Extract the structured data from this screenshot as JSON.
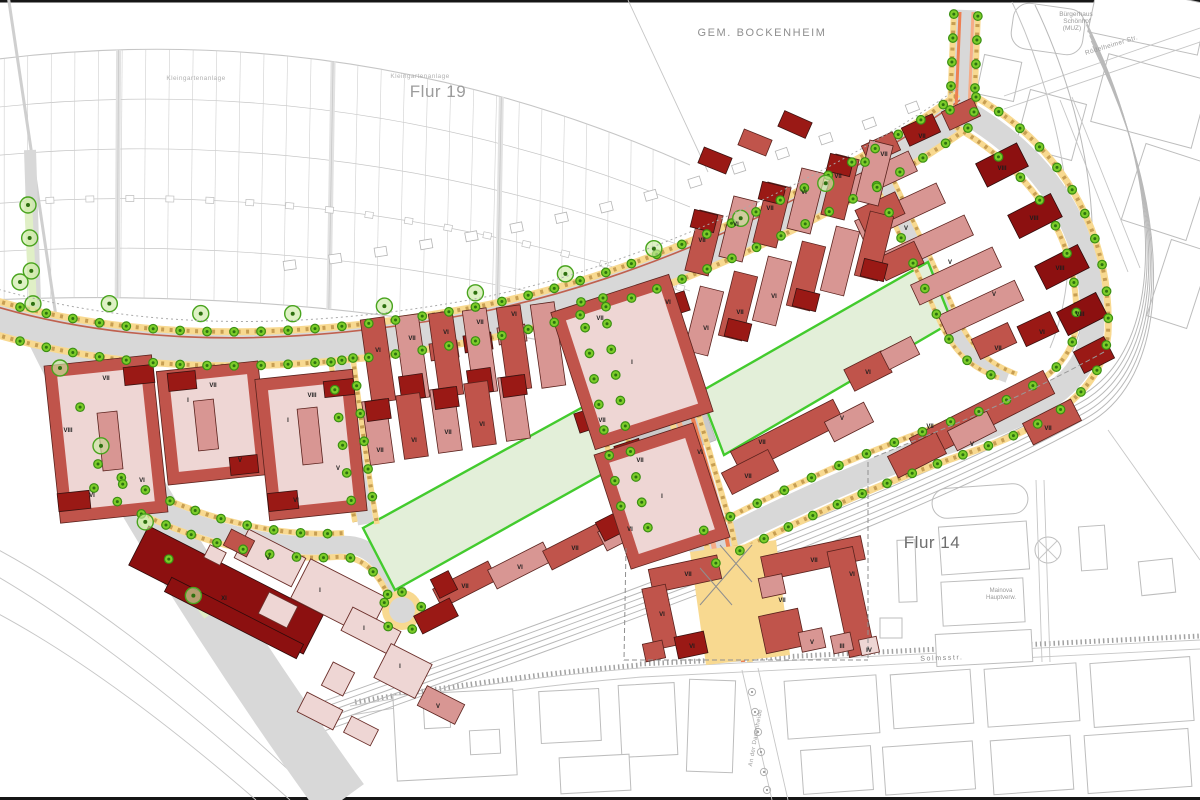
{
  "map": {
    "area_labels": [
      {
        "text": "GEM. BOCKENHEIM",
        "x": 762,
        "y": 36,
        "size": 11,
        "color": "#8f8f8f",
        "spacing": 1.6
      },
      {
        "text": "Flur 19",
        "x": 438,
        "y": 97,
        "size": 17,
        "color": "#9c9c9c",
        "spacing": 0.5
      },
      {
        "text": "Flur 14",
        "x": 932,
        "y": 548,
        "size": 17,
        "color": "#6e6e6e",
        "spacing": 0.5
      },
      {
        "text": "Kleingartenanlage",
        "x": 196,
        "y": 80,
        "size": 6.5,
        "color": "#b2b2b2",
        "spacing": 0.4
      },
      {
        "text": "Kleingartenanlage",
        "x": 420,
        "y": 78,
        "size": 6.5,
        "color": "#b2b2b2",
        "spacing": 0.4
      },
      {
        "text": "Bürgerhaus",
        "x": 1076,
        "y": 16,
        "size": 6.5,
        "color": "#9a9a9a",
        "spacing": 0
      },
      {
        "text": "Schönhof",
        "x": 1077,
        "y": 23,
        "size": 6.5,
        "color": "#9a9a9a",
        "spacing": 0
      },
      {
        "text": "(MUZ)",
        "x": 1072,
        "y": 30,
        "size": 6.5,
        "color": "#9a9a9a",
        "spacing": 0
      },
      {
        "text": "Mainova",
        "x": 1001,
        "y": 592,
        "size": 6,
        "color": "#9a9a9a",
        "spacing": 0
      },
      {
        "text": "Hauptverw.",
        "x": 1001,
        "y": 599,
        "size": 6,
        "color": "#9a9a9a",
        "spacing": 0
      }
    ],
    "street_labels": [
      {
        "text": "Rödelheimer Str.",
        "x": 1112,
        "y": 47,
        "size": 6.5,
        "color": "#9a9a9a",
        "rotate": -17,
        "spacing": 0.4
      },
      {
        "text": "Solmsstr.",
        "x": 942,
        "y": 660,
        "size": 7,
        "color": "#8a8a8a",
        "rotate": -2,
        "spacing": 1.6
      },
      {
        "text": "An der Dammheide",
        "x": 757,
        "y": 738,
        "size": 6,
        "color": "#9a9a9a",
        "rotate": -80,
        "spacing": 0.4
      }
    ],
    "building_floor_labels": [
      {
        "t": "VII",
        "x": 106,
        "y": 380
      },
      {
        "t": "VIII",
        "x": 68,
        "y": 432
      },
      {
        "t": "VI",
        "x": 92,
        "y": 497
      },
      {
        "t": "VI",
        "x": 142,
        "y": 482
      },
      {
        "t": "VII",
        "x": 213,
        "y": 387
      },
      {
        "t": "I",
        "x": 188,
        "y": 402
      },
      {
        "t": "V",
        "x": 240,
        "y": 462
      },
      {
        "t": "VIII",
        "x": 312,
        "y": 397
      },
      {
        "t": "I",
        "x": 288,
        "y": 422
      },
      {
        "t": "V",
        "x": 338,
        "y": 470
      },
      {
        "t": "VI",
        "x": 296,
        "y": 502
      },
      {
        "t": "VI",
        "x": 378,
        "y": 352
      },
      {
        "t": "VII",
        "x": 412,
        "y": 340
      },
      {
        "t": "VI",
        "x": 446,
        "y": 334
      },
      {
        "t": "VII",
        "x": 480,
        "y": 324
      },
      {
        "t": "VI",
        "x": 514,
        "y": 316
      },
      {
        "t": "VII",
        "x": 380,
        "y": 452
      },
      {
        "t": "VI",
        "x": 414,
        "y": 442
      },
      {
        "t": "VII",
        "x": 448,
        "y": 434
      },
      {
        "t": "VI",
        "x": 482,
        "y": 426
      },
      {
        "t": "VII",
        "x": 600,
        "y": 320
      },
      {
        "t": "VI",
        "x": 668,
        "y": 304
      },
      {
        "t": "VII",
        "x": 602,
        "y": 422
      },
      {
        "t": "I",
        "x": 632,
        "y": 364
      },
      {
        "t": "VII",
        "x": 640,
        "y": 462
      },
      {
        "t": "VI",
        "x": 700,
        "y": 454
      },
      {
        "t": "I",
        "x": 662,
        "y": 498
      },
      {
        "t": "VII",
        "x": 702,
        "y": 242
      },
      {
        "t": "VI",
        "x": 736,
        "y": 226
      },
      {
        "t": "VII",
        "x": 770,
        "y": 210
      },
      {
        "t": "VI",
        "x": 804,
        "y": 194
      },
      {
        "t": "VII",
        "x": 838,
        "y": 178
      },
      {
        "t": "VI",
        "x": 706,
        "y": 330
      },
      {
        "t": "VII",
        "x": 740,
        "y": 314
      },
      {
        "t": "VI",
        "x": 774,
        "y": 298
      },
      {
        "t": "VII",
        "x": 884,
        "y": 156
      },
      {
        "t": "VII",
        "x": 922,
        "y": 138
      },
      {
        "t": "VIII",
        "x": 1002,
        "y": 170
      },
      {
        "t": "VIII",
        "x": 1034,
        "y": 220
      },
      {
        "t": "VIII",
        "x": 1060,
        "y": 270
      },
      {
        "t": "VIII",
        "x": 1080,
        "y": 316
      },
      {
        "t": "V",
        "x": 906,
        "y": 230
      },
      {
        "t": "V",
        "x": 950,
        "y": 264
      },
      {
        "t": "V",
        "x": 994,
        "y": 296
      },
      {
        "t": "VII",
        "x": 998,
        "y": 350
      },
      {
        "t": "VI",
        "x": 1042,
        "y": 334
      },
      {
        "t": "VII",
        "x": 762,
        "y": 444
      },
      {
        "t": "VII",
        "x": 748,
        "y": 478
      },
      {
        "t": "V",
        "x": 842,
        "y": 420
      },
      {
        "t": "VII",
        "x": 930,
        "y": 428
      },
      {
        "t": "VII",
        "x": 1048,
        "y": 430
      },
      {
        "t": "V",
        "x": 972,
        "y": 446
      },
      {
        "t": "VI",
        "x": 868,
        "y": 374
      },
      {
        "t": "VII",
        "x": 465,
        "y": 588
      },
      {
        "t": "VI",
        "x": 520,
        "y": 569
      },
      {
        "t": "VII",
        "x": 575,
        "y": 550
      },
      {
        "t": "VI",
        "x": 630,
        "y": 531
      },
      {
        "t": "VII",
        "x": 688,
        "y": 576
      },
      {
        "t": "VI",
        "x": 662,
        "y": 616
      },
      {
        "t": "VI",
        "x": 692,
        "y": 648
      },
      {
        "t": "VII",
        "x": 814,
        "y": 562
      },
      {
        "t": "VII",
        "x": 782,
        "y": 602
      },
      {
        "t": "VI",
        "x": 852,
        "y": 576
      },
      {
        "t": "V",
        "x": 812,
        "y": 644
      },
      {
        "t": "III",
        "x": 842,
        "y": 648
      },
      {
        "t": "IV",
        "x": 869,
        "y": 652
      },
      {
        "t": "V",
        "x": 268,
        "y": 560
      },
      {
        "t": "I",
        "x": 320,
        "y": 592
      },
      {
        "t": "I",
        "x": 364,
        "y": 630
      },
      {
        "t": "I",
        "x": 400,
        "y": 668
      },
      {
        "t": "V",
        "x": 438,
        "y": 708
      },
      {
        "t": "XI",
        "x": 224,
        "y": 600
      }
    ],
    "colors": {
      "road": "#d8d8d8",
      "plaza": "#cacaca",
      "yellow_strip": "#f8d990",
      "dash_brown": "#c79e52",
      "orange_stripe": "#ee7f52",
      "salmon_stripe": "#f6ac86",
      "red_line": "#c0614f",
      "park_fill": "#e3efd9",
      "park_edge": "#43cb2e",
      "verge_green": "#e0efc6",
      "tree_fill": "#7ccc29",
      "tree_ring": "#3a8f12",
      "bld_red": "#c0544b",
      "bld_dark": "#9a1915",
      "bld_light": "#d89693",
      "bld_pale": "#eed6d4",
      "bld_maroon": "#8c1010",
      "cadastre": "#c6c6c6"
    }
  }
}
